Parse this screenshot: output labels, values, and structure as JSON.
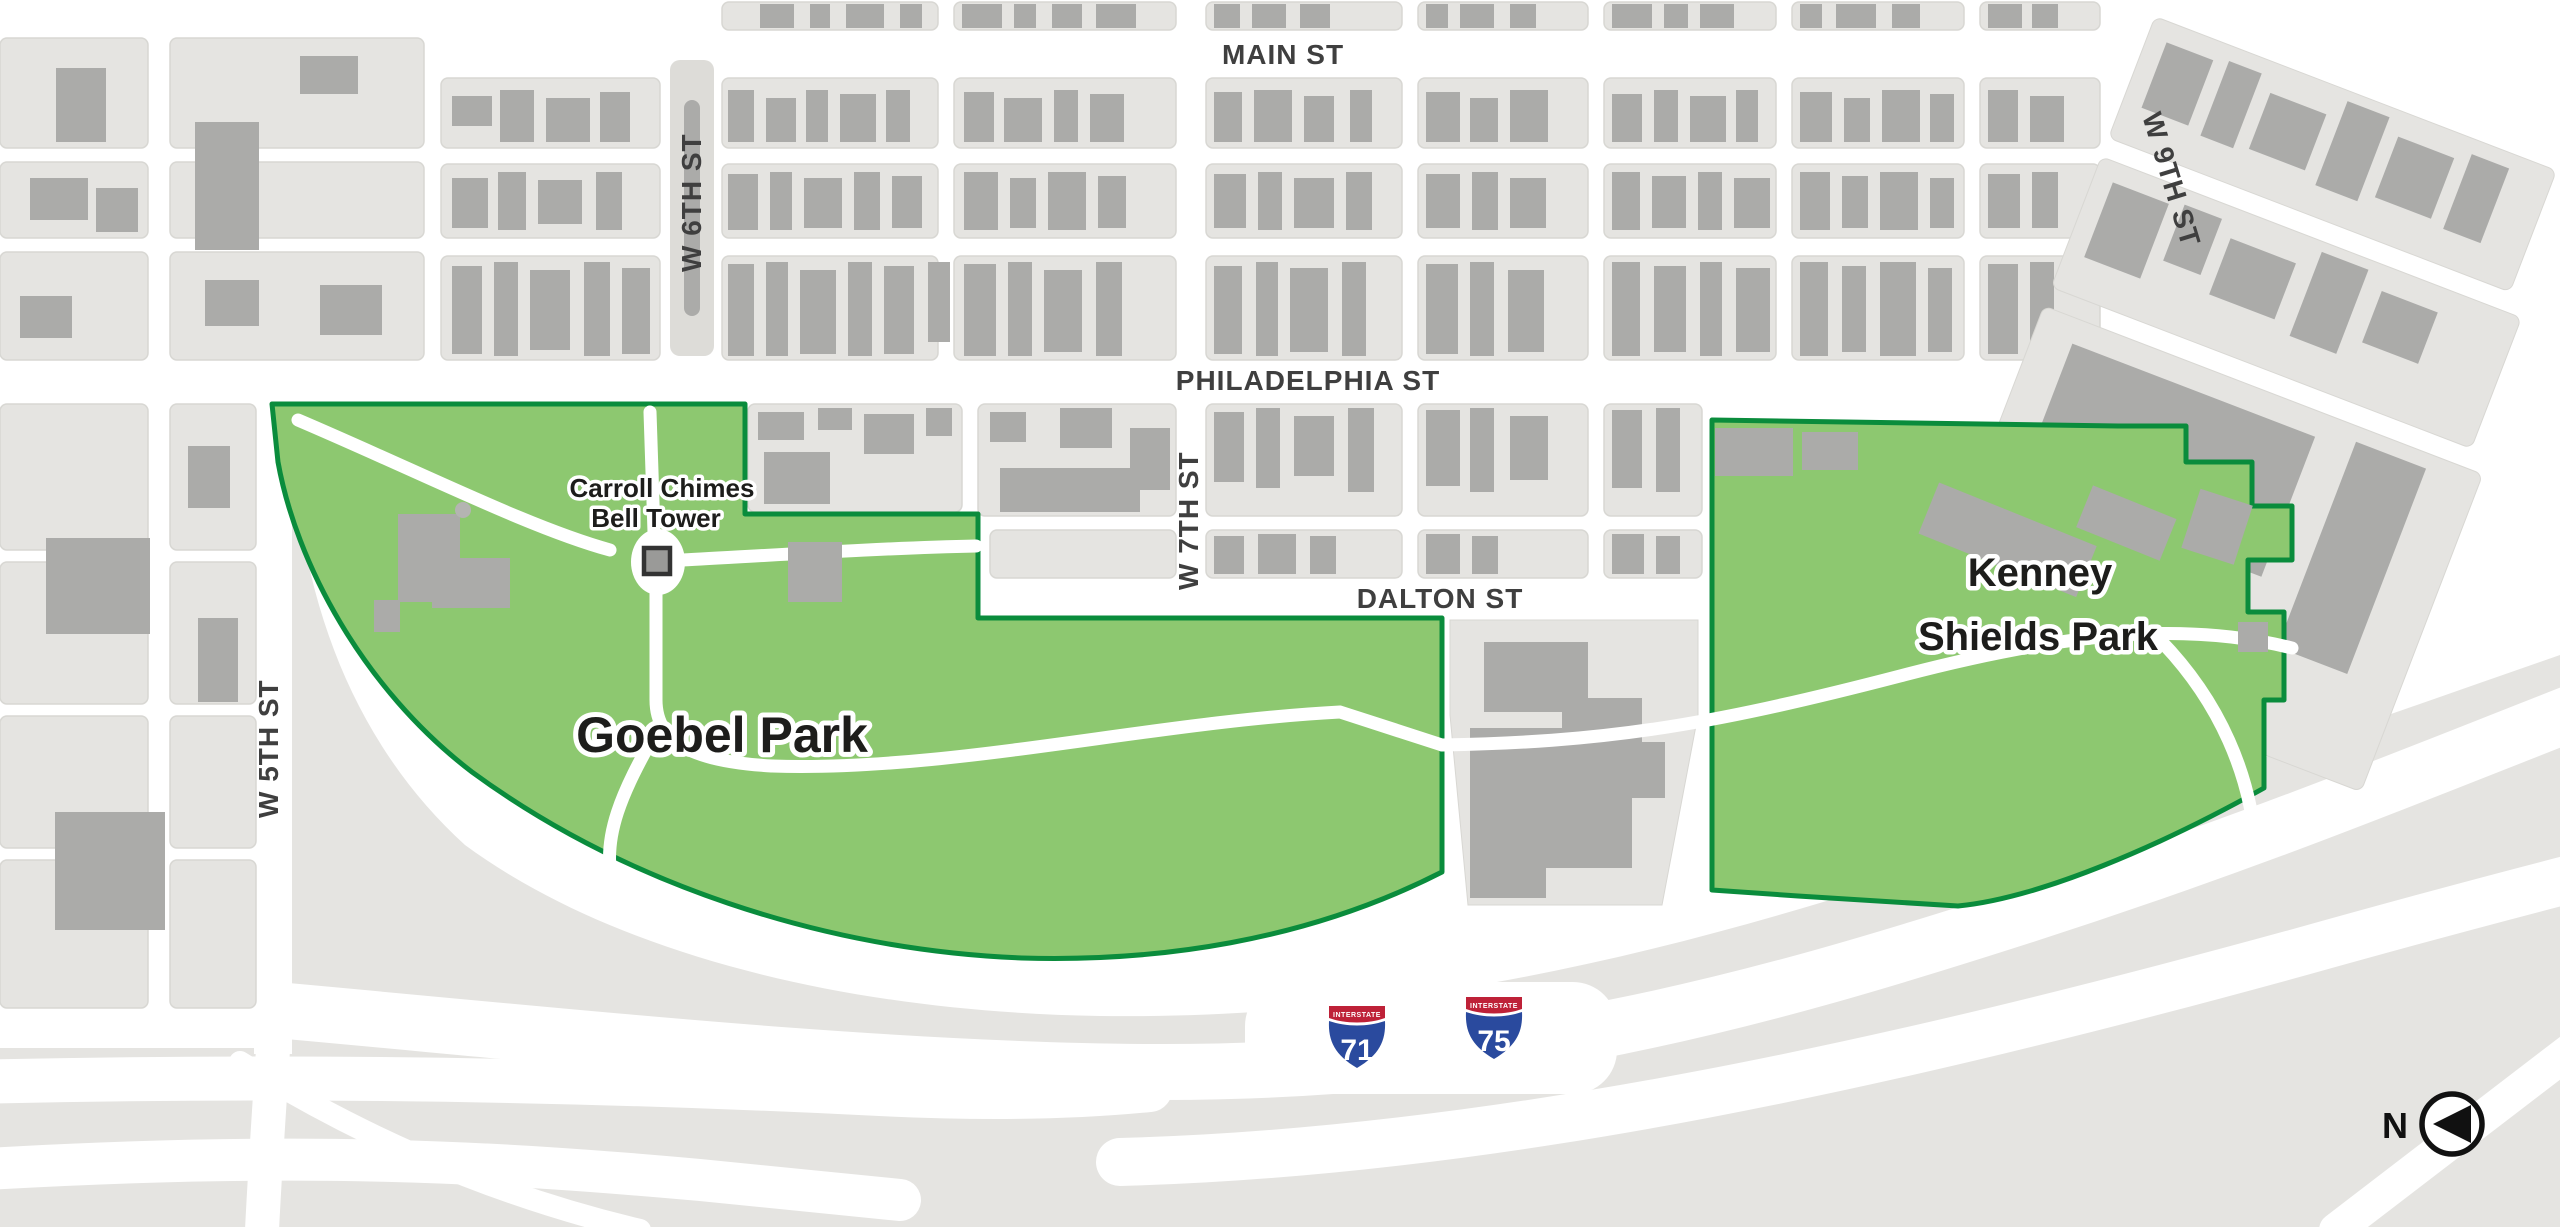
{
  "map": {
    "title": "Goebel Park and Kenney Shields Park area map",
    "street_labels": {
      "main": "MAIN ST",
      "philadelphia": "PHILADELPHIA ST",
      "dalton": "DALTON ST",
      "w5th": "W 5TH ST",
      "w6th": "W 6TH ST",
      "w7th": "W 7TH ST",
      "w9th": "W 9TH ST"
    },
    "parks": {
      "goebel": {
        "name": "Goebel Park"
      },
      "kenney": {
        "name": "Kenney Shields Park",
        "line1": "Kenney",
        "line2": "Shields Park"
      }
    },
    "poi": {
      "bell_tower": {
        "name": "Carroll Chimes Bell Tower",
        "line1": "Carroll Chimes",
        "line2": "Bell Tower"
      }
    },
    "highways": [
      {
        "type": "interstate",
        "banner": "INTERSTATE",
        "number": "71"
      },
      {
        "type": "interstate",
        "banner": "INTERSTATE",
        "number": "75"
      }
    ],
    "north_indicator": {
      "label": "N"
    },
    "colors": {
      "park_fill": "#8DC870",
      "park_border": "#0A8C3C",
      "block_fill": "#E5E4E1",
      "building_fill": "#ABABA9",
      "road_fill": "#FFFFFF",
      "interstate_red": "#BE2138",
      "interstate_blue": "#2A4A9E",
      "label_color": "#3F3F3F"
    }
  }
}
